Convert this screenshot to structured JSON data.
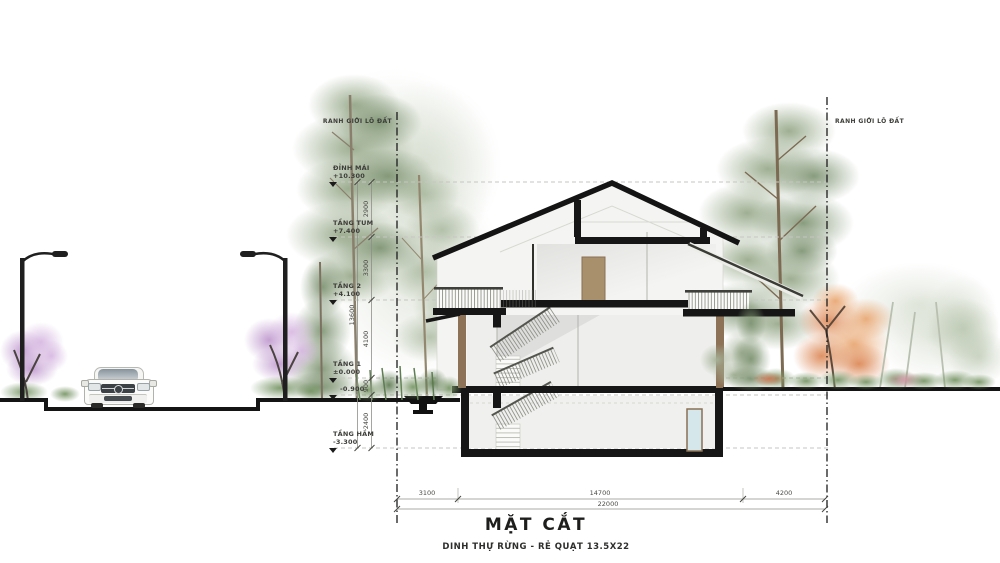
{
  "drawing": {
    "title": "MẶT CẮT",
    "subtitle": "DINH THỰ RỪNG - RẺ QUẠT 13.5X22"
  },
  "boundary": {
    "left_label": "RANH GIỚI LÔ ĐẤT",
    "right_label": "RANH GIỚI LÔ ĐẤT"
  },
  "levels": {
    "roof": {
      "name": "ĐỈNH MÁI",
      "elev": "+10.300"
    },
    "tum": {
      "name": "TẦNG TUM",
      "elev": "+7.400"
    },
    "floor2": {
      "name": "TẦNG 2",
      "elev": "+4.100"
    },
    "floor1": {
      "name": "TẦNG 1",
      "elev": "±0.000"
    },
    "ground": {
      "elev": "-0.900"
    },
    "basement": {
      "name": "TẦNG HẦM",
      "elev": "-3.300"
    }
  },
  "dimensions": {
    "vertical": {
      "s1": "2900",
      "s2": "3300",
      "s3": "4100",
      "s4": "900",
      "s5": "2400",
      "total": "13600"
    },
    "horizontal": {
      "s1": "3100",
      "s2": "14700",
      "s3": "4200",
      "total": "22000"
    }
  },
  "colors": {
    "linework": "#141414",
    "wood": "#8d7257",
    "basement_door": "#d6e7ec",
    "foliage_green": "#96a989",
    "foliage_orange": "#db8653",
    "foliage_purple": "#be96cd"
  }
}
